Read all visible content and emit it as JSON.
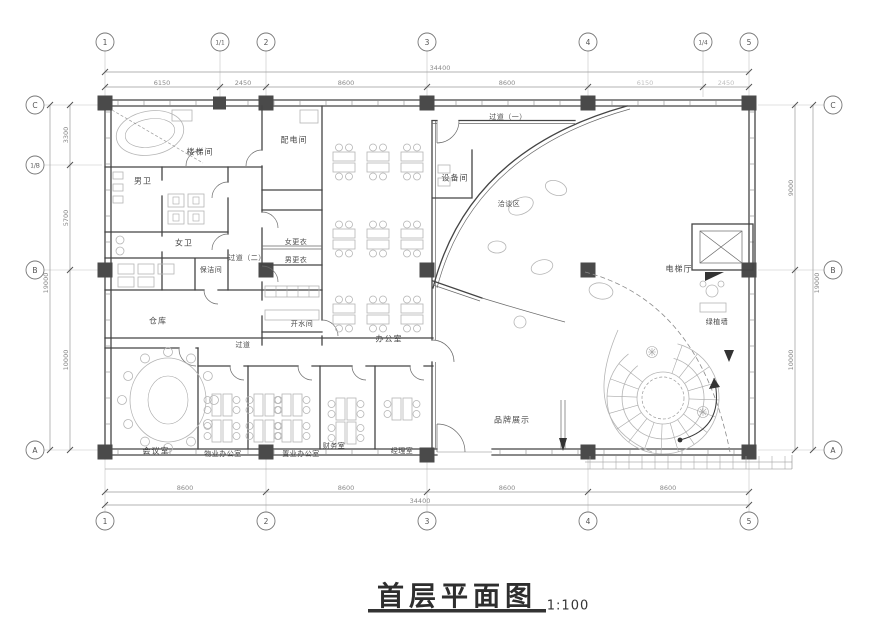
{
  "title": {
    "text": "首层平面图",
    "scale": "1:100"
  },
  "grid": {
    "top": [
      "1",
      "1/1",
      "2",
      "3",
      "4",
      "1/4",
      "5"
    ],
    "bottom": [
      "1",
      "2",
      "3",
      "4",
      "5"
    ],
    "left": [
      "C",
      "1/B",
      "B",
      "A"
    ],
    "right": [
      "C",
      "B",
      "A"
    ]
  },
  "dimensions": {
    "top_total": "34400",
    "top_segments": [
      "6150",
      "2450",
      "8600",
      "8600",
      "6150",
      "2450"
    ],
    "bottom_total": "34400",
    "bottom_segments": [
      "8600",
      "8600",
      "8600",
      "8600"
    ],
    "left_total": "19000",
    "left_segments": [
      "3300",
      "5700",
      "10000"
    ],
    "right_total": "19000",
    "right_segments": [
      "9000",
      "10000"
    ]
  },
  "rooms": {
    "stair_hall": "楼梯间",
    "mens_wc": "男卫",
    "womens_wc": "女卫",
    "electrical": "配电间",
    "corridor2": "过道（二）",
    "cleaning": "保洁间",
    "women_locker": "女更衣",
    "men_locker": "男更衣",
    "pantry": "开水间",
    "storage": "仓库",
    "open_office": "办公室",
    "equipment": "设备间",
    "corridor1": "过道（一）",
    "negotiation": "洽谈区",
    "brand_display": "品牌展示",
    "elevator_hall": "电梯厅",
    "green_wall": "绿植墙",
    "corridor": "过道",
    "meeting": "会议室",
    "property_office": "物业办公室",
    "sales_office": "置业办公室",
    "finance": "财务室",
    "manager": "经理室"
  }
}
